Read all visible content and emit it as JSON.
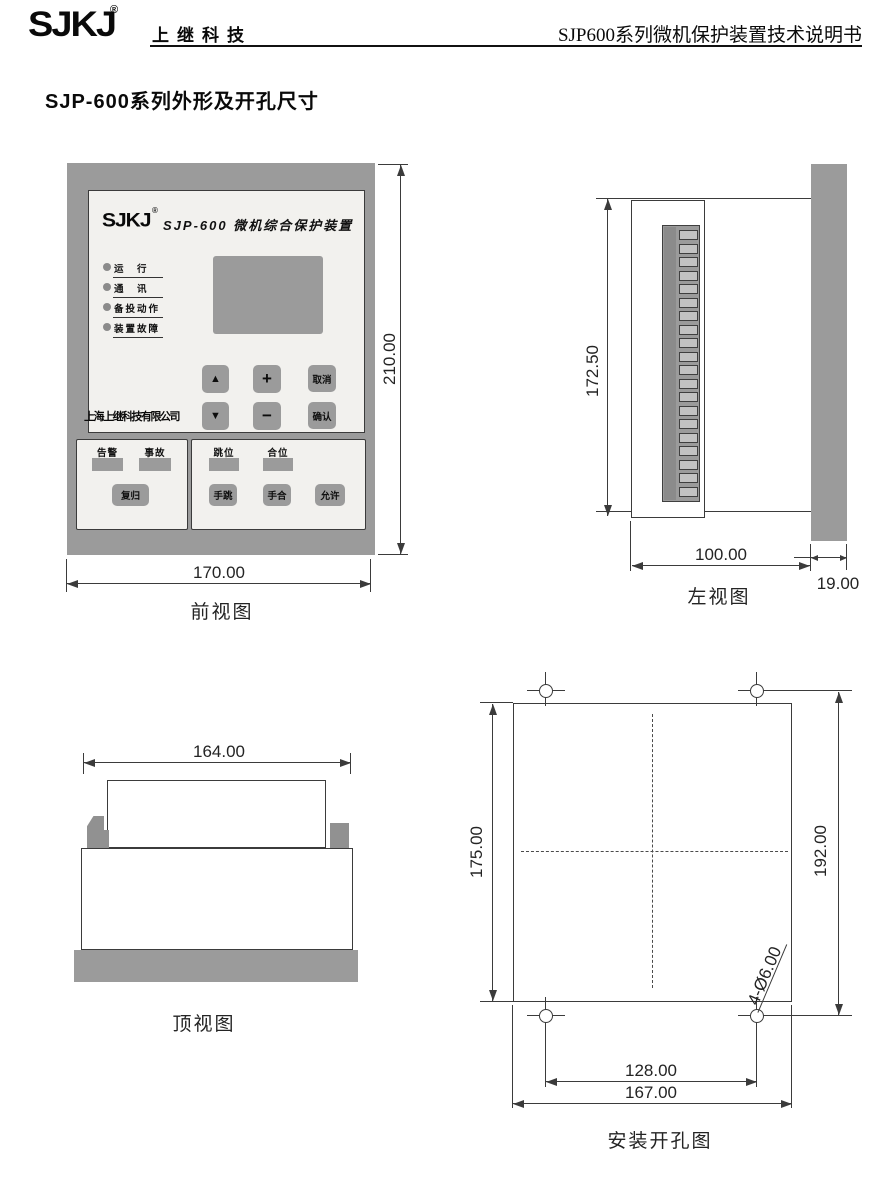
{
  "header": {
    "logo": "SJKJ",
    "registered_mark": "®",
    "brand": "上继科技",
    "doc_title": "SJP600系列微机保护装置技术说明书"
  },
  "section_title": "SJP-600系列外形及开孔尺寸",
  "colors": {
    "device_gray": "#9b9b9b",
    "panel_face": "#f2f1ee",
    "drawing_line": "#3b3b3b"
  },
  "front_view": {
    "caption": "前视图",
    "dim_width": "170.00",
    "dim_height": "210.00",
    "panel": {
      "logo": "SJKJ",
      "registered_mark": "®",
      "title": "SJP-600 微机综合保护装置",
      "company": "上海上继科技有限公司",
      "leds": [
        {
          "label": "运　行"
        },
        {
          "label": "通　讯"
        },
        {
          "label": "备投动作"
        },
        {
          "label": "装置故障"
        }
      ],
      "keys": {
        "up": "▲",
        "plus": "+",
        "cancel": "取消",
        "down": "▼",
        "minus": "−",
        "confirm": "确认"
      },
      "alarm_box": {
        "labels": [
          "告警",
          "事故"
        ],
        "reset": "复归"
      },
      "switch_box": {
        "labels": [
          "跳位",
          "合位"
        ],
        "buttons": [
          "手跳",
          "手合",
          "允许"
        ]
      }
    }
  },
  "left_view": {
    "caption": "左视图",
    "dim_height": "172.50",
    "dim_depth": "100.00",
    "dim_panel": "19.00"
  },
  "top_view": {
    "caption": "顶视图",
    "dim_width": "164.00"
  },
  "cutout_view": {
    "caption": "安装开孔图",
    "dim_height": "175.00",
    "dim_hole_height": "192.00",
    "dim_hole_spacing": "128.00",
    "dim_width": "167.00",
    "hole_note": "4-Ø6.00"
  }
}
